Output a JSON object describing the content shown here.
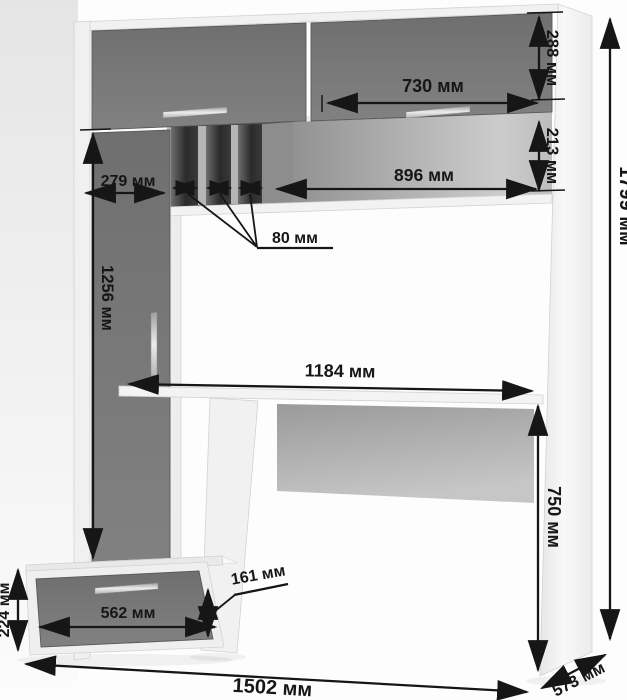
{
  "diagram": {
    "kind": "furniture-dimension-drawing",
    "subject": "computer desk with wall unit"
  },
  "dimensions": {
    "overall_height": "1799 мм",
    "overall_width": "1502 мм",
    "overall_depth": "573 мм",
    "top_door_height": "288 мм",
    "top_right_door_width": "730 мм",
    "open_niche_height": "213 мм",
    "open_niche_width": "896 мм",
    "left_top_section_width": "279 мм",
    "pigeonhole_slot_width": "80 мм",
    "left_door_height": "1256 мм",
    "desktop_width": "1184 мм",
    "desktop_height": "750 мм",
    "pedestal_height": "224 мм",
    "drawer_width": "562 мм",
    "drawer_front_height": "161 мм"
  },
  "colors": {
    "dimension_line": "#161616",
    "door_gray": "#787878",
    "panel_white": "#f1f1f1",
    "slot_dark": "#2c2c2c",
    "niche_back_gray": "#a8a8a8",
    "background": "#fdfdfd"
  }
}
